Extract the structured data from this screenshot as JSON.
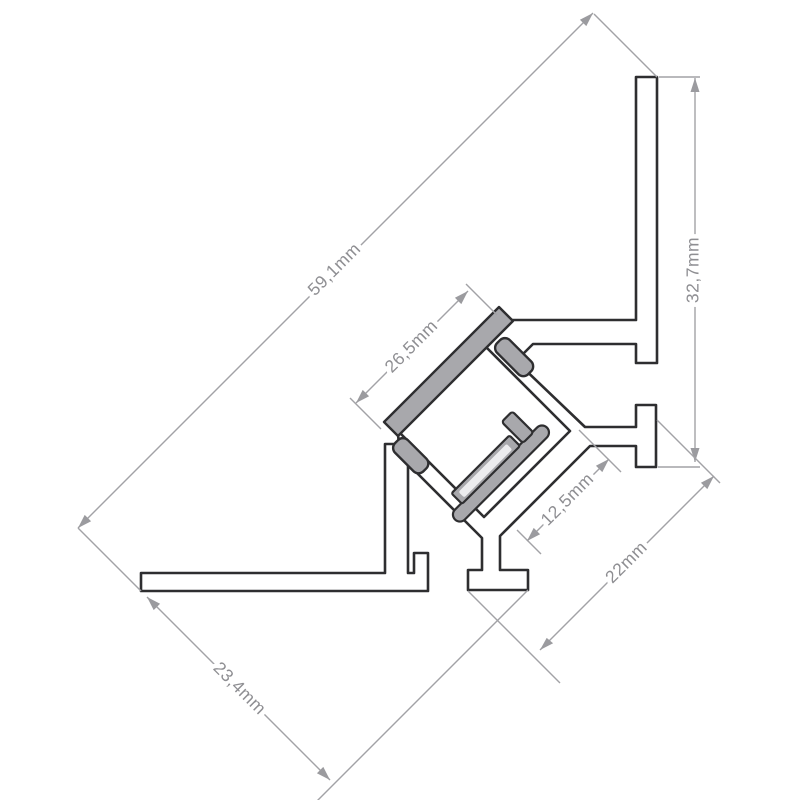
{
  "drawing": {
    "title": "LED corner aluminium profile cross-section",
    "type": "technical-dimension-drawing",
    "units": "mm",
    "dimensions": [
      {
        "id": "d591",
        "label": "59,1mm",
        "value": 59.1,
        "measures": "overall diagonal length"
      },
      {
        "id": "d327",
        "label": "32,7mm",
        "value": 32.7,
        "measures": "vertical flange height"
      },
      {
        "id": "d265",
        "label": "26,5mm",
        "value": 26.5,
        "measures": "cover face width"
      },
      {
        "id": "d125",
        "label": "12,5mm",
        "value": 12.5,
        "measures": "inner channel width"
      },
      {
        "id": "d22",
        "label": "22mm",
        "value": 22.0,
        "measures": "profile depth"
      },
      {
        "id": "d234",
        "label": "23,4mm",
        "value": 23.4,
        "measures": "bottom flange length"
      }
    ],
    "components": {
      "profile_body": "aluminium profile outline",
      "cover_plate": "clip-on diffuser cover",
      "led_module": "LED strip on mounting plate"
    },
    "colors": {
      "background": "#ffffff",
      "outline": "#2e2e30",
      "aluminum_fill": "#ffffff",
      "cover_fill": "#a8a8ac",
      "led_pcb_fill": "#ececee",
      "dimension_line": "#a2a2a6",
      "dimension_arrow": "#9b9b9f",
      "dimension_text": "#8e8e92"
    }
  }
}
